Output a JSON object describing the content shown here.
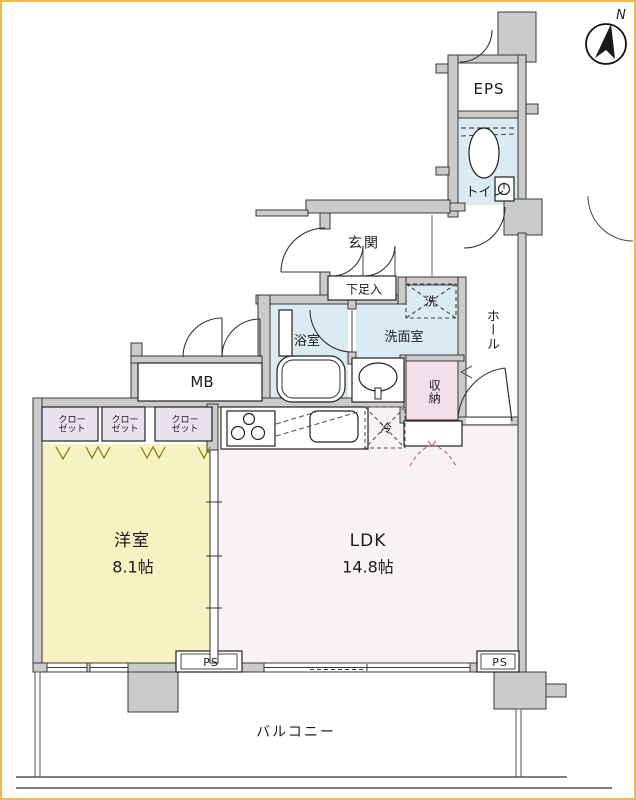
{
  "floorplan": {
    "compass": {
      "north_label": "N"
    },
    "labels": {
      "eps": "EPS",
      "toilet": "トイレ",
      "entrance": "玄関",
      "shoe_cabinet": "下足入",
      "washer": "洗",
      "washroom": "洗面室",
      "hall": "ホール",
      "bathroom": "浴室",
      "meter_box": "MB",
      "storage": "収納",
      "refrigerator": "冷",
      "western_room_name": "洋室",
      "western_room_size": "8.1帖",
      "ldk_name": "LDK",
      "ldk_size": "14.8帖",
      "pipe_space_left": "PS",
      "pipe_space_right": "PS",
      "balcony": "バルコニー"
    },
    "closets": [
      {
        "line1": "クロー",
        "line2": "ゼット"
      },
      {
        "line1": "クロー",
        "line2": "ゼット"
      },
      {
        "line1": "クロー",
        "line2": "ゼット"
      }
    ],
    "colors": {
      "wall": "#cbcbcb",
      "wall_stroke": "#3a3a3a",
      "western_room": "#f6f2c2",
      "ldk": "#f8f2f6",
      "wet_room_blue": "#daecf2",
      "closet": "#e9e1ee",
      "storage_pink": "#f3dfe9",
      "dashed_pink": "#c06080",
      "fusuma_mark": "#8f7f10",
      "frame_border": "#f2b94b"
    }
  }
}
